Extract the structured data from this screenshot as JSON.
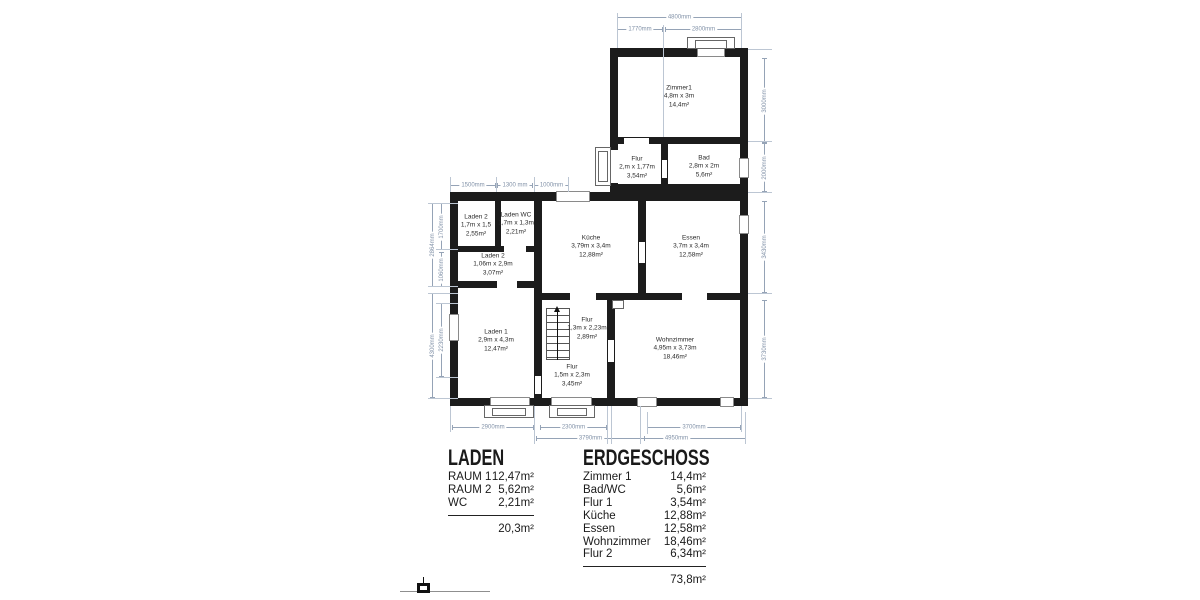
{
  "plan": {
    "rooms": [
      {
        "name": "Zimmer1",
        "size": "4,8m x 3m",
        "area": "14,4m²"
      },
      {
        "name": "Flur",
        "size": "2,m x 1,77m",
        "area": "3,54m²"
      },
      {
        "name": "Bad",
        "size": "2,8m x 2m",
        "area": "5,6m²"
      },
      {
        "name": "Laden 2",
        "size": "1,7m x 1,5",
        "area": "2,55m²"
      },
      {
        "name": "Laden WC",
        "size": "1,7m x 1,3m",
        "area": "2,21m²"
      },
      {
        "name": "Laden 2",
        "size": "1,06m x 2,9m",
        "area": "3,07m²"
      },
      {
        "name": "Küche",
        "size": "3,79m x 3,4m",
        "area": "12,88m²"
      },
      {
        "name": "Essen",
        "size": "3,7m x 3,4m",
        "area": "12,58m²"
      },
      {
        "name": "Laden 1",
        "size": "2,9m x 4,3m",
        "area": "12,47m²"
      },
      {
        "name": "Flur",
        "size": "1,3m x 2,23m",
        "area": "2,89m²"
      },
      {
        "name": "Wohnzimmer",
        "size": "4,95m x 3,73m",
        "area": "18,46m²"
      },
      {
        "name": "Flur",
        "size": "1,5m x 2,3m",
        "area": "3,45m²"
      }
    ],
    "dims": {
      "top": [
        "4800mm",
        "1770mm",
        "2800mm"
      ],
      "upper_mid": [
        "1500mm",
        "1300 mm",
        "1000mm"
      ],
      "left": [
        "2864mm",
        "1700mm",
        "1060mm",
        "2230mm",
        "4300mm"
      ],
      "right": [
        "3000mm",
        "2000mm",
        "3430mm",
        "3730mm"
      ],
      "bottom": [
        "2900mm",
        "2300mm",
        "3700mm",
        "3790mm",
        "4950mm"
      ]
    }
  },
  "tables": {
    "laden": {
      "title": "LADEN",
      "rows": [
        {
          "name": "RAUM 1",
          "value": "12,47m²"
        },
        {
          "name": "RAUM 2",
          "value": "5,62m²"
        },
        {
          "name": "WC",
          "value": "2,21m²"
        }
      ],
      "total": "20,3m²"
    },
    "erdgeschoss": {
      "title": "ERDGESCHOSS",
      "rows": [
        {
          "name": "Zimmer 1",
          "value": "14,4m²"
        },
        {
          "name": "Bad/WC",
          "value": "5,6m²"
        },
        {
          "name": "Flur 1",
          "value": "3,54m²"
        },
        {
          "name": "Küche",
          "value": "12,88m²"
        },
        {
          "name": "Essen",
          "value": "12,58m²"
        },
        {
          "name": "Wohnzimmer",
          "value": "18,46m²"
        },
        {
          "name": "Flur 2",
          "value": "6,34m²"
        }
      ],
      "total": "73,8m²"
    }
  },
  "colors": {
    "wall": "#1c1c1c",
    "dimension": "#95a3b6",
    "text": "#1a1a1a"
  }
}
